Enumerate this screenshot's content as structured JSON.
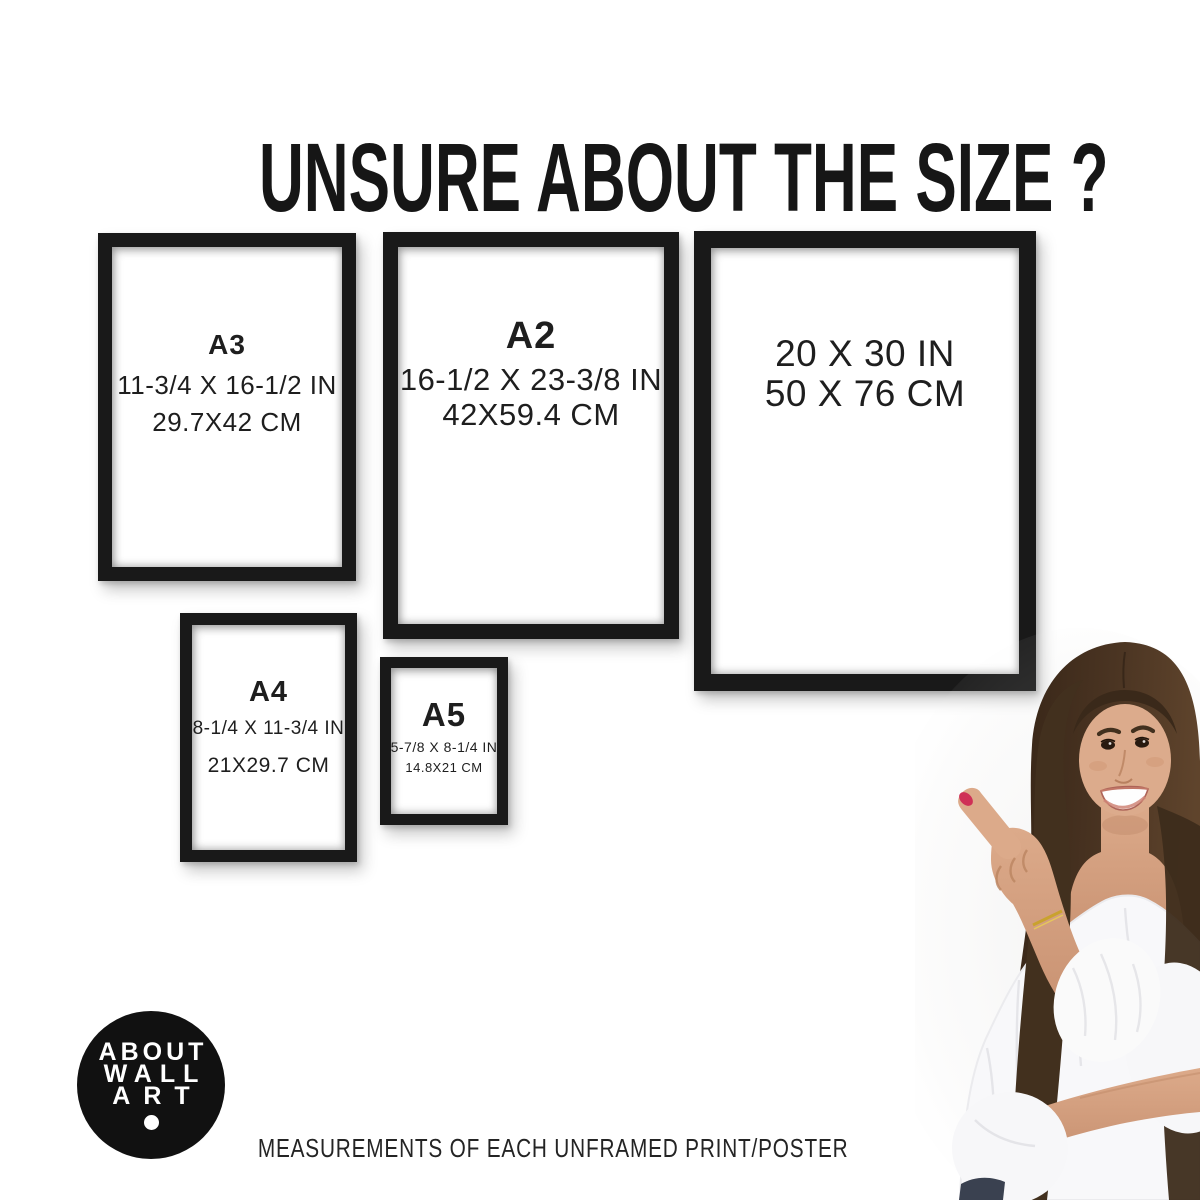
{
  "title": "UNSURE ABOUT THE SIZE ?",
  "caption": "MEASUREMENTS OF EACH UNFRAMED PRINT/POSTER",
  "logo": {
    "lines": [
      "ABOUT",
      "WALL",
      "ART"
    ]
  },
  "frames": {
    "a3": {
      "label": "A3",
      "inches": "11-3/4 X 16-1/2 IN",
      "cm": "29.7X42 CM"
    },
    "a2": {
      "label": "A2",
      "inches": "16-1/2 X 23-3/8 IN",
      "cm": "42X59.4 CM"
    },
    "poster20x30": {
      "inches": "20 X 30 IN",
      "cm": "50 X 76 CM"
    },
    "a4": {
      "label": "A4",
      "inches": "8-1/4 X 11-3/4 IN",
      "cm": "21X29.7 CM"
    },
    "a5": {
      "label": "A5",
      "inches": "5-7/8 X 8-1/4 IN",
      "cm": "14.8X21 CM"
    }
  },
  "colors": {
    "background": "#ffffff",
    "frame_black": "#191919",
    "text": "#1e1e1e",
    "logo_bg": "#111111",
    "logo_text": "#ffffff",
    "nail_polish": "#cf3056",
    "hair": "#4a3422",
    "skin": "#d7a183",
    "blouse": "#f8f8fa",
    "bracelet": "#c9a22e",
    "jeans": "#3a4150"
  }
}
